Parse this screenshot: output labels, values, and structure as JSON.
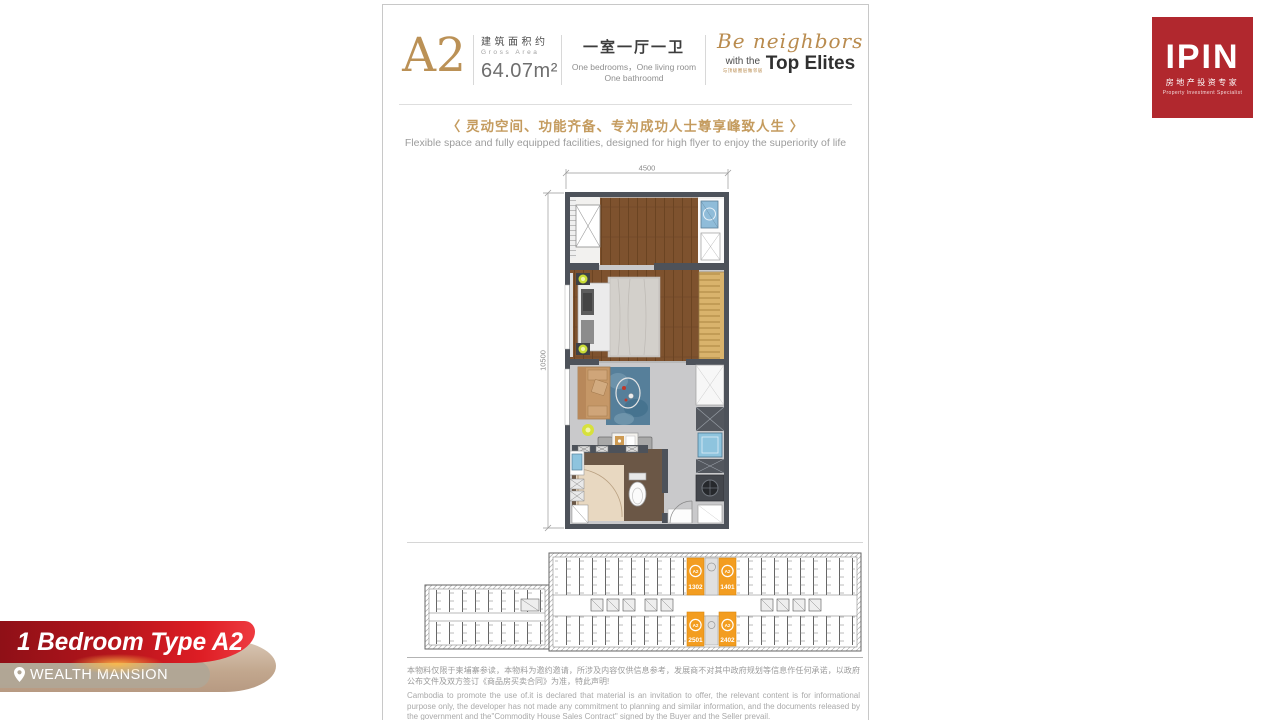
{
  "header": {
    "type_code": "A2",
    "area_label_zh": "建筑面积约",
    "area_label_en": "Gross Area",
    "area_value": "64.07m²",
    "unit_mix_zh": "一室一厅一卫",
    "unit_mix_en1": "One bedrooms，One living room",
    "unit_mix_en2": "One bathroomd",
    "elites_script": "Be neighbors",
    "elites_with": "with the",
    "elites_zh": "与顶级圈层做邻居",
    "elites_bold": "Top Elites"
  },
  "tagline": {
    "zh": "〈 灵动空间、功能齐备、专为成功人士尊享峰致人生 〉",
    "en": "Flexible space and fully equipped facilities, designed for high flyer to enjoy the superiority of life"
  },
  "plan": {
    "dim_width": "4500",
    "dim_height": "10500"
  },
  "keyplan": {
    "units": [
      {
        "badge": "A2",
        "number": "1302"
      },
      {
        "badge": "A2",
        "number": "1401"
      },
      {
        "badge": "A2",
        "number": "2501"
      },
      {
        "badge": "A2",
        "number": "2402"
      }
    ]
  },
  "disclaimer": {
    "zh": "本物料仅限于柬埔寨参读，本物料为邀约邀请，所涉及内容仅供信息参考，发展商不对其中政府规划等信息作任何承诺，以政府公布文件及双方签订《商品房买卖合同》为准，特此声明!",
    "en": "Cambodia to promote the use of.it is declared that material is an invitation to offer, the relevant content is for informational purpose only, the developer has not made any commitment to planning and similar information, and the documents released by the government and the\"Commodity House Sales Contract\" signed by the Buyer and the Seller prevail."
  },
  "logo": {
    "name": "IPIN",
    "tagline_zh": "房地产投资专家",
    "tagline_en": "Property Investment Specialist"
  },
  "ribbon": {
    "title": "1 Bedroom Type A2",
    "location": "WEALTH MANSION"
  },
  "colors": {
    "gold": "#bb9156",
    "ribbon_red": "#c4161c",
    "keyplan_orange": "#f39d20",
    "logo_red": "#b1282e",
    "wall_gray": "#4d525a"
  }
}
